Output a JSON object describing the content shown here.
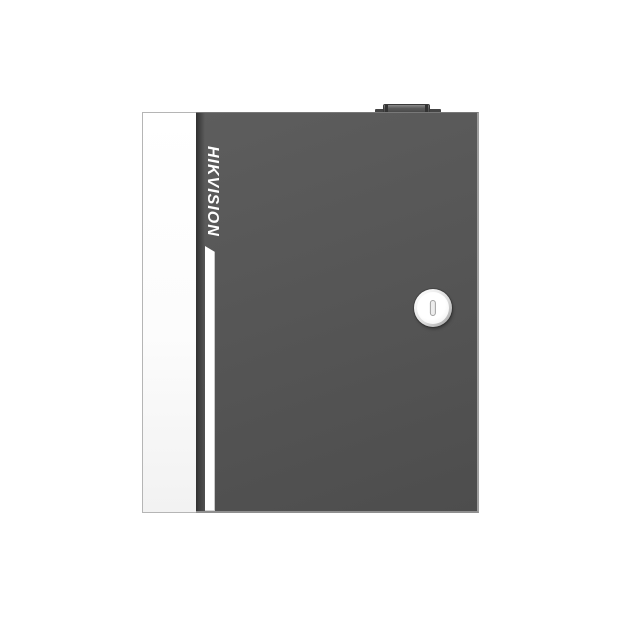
{
  "scene": {
    "type": "product-photo",
    "subject": "Wall-mount access control panel enclosure, front view, on white background"
  },
  "brand": {
    "logo_text": "HIKVISION"
  },
  "icons": {
    "keyhole_lock": "round-cam-lock-with-vertical-key-slot",
    "top_tab": "small-raised-latch-tab-on-top-edge"
  },
  "colors": {
    "background": "#ffffff",
    "door": "#565656",
    "door_top_highlight": "#787878",
    "door_edge_highlight": "#9e9e9e",
    "hinge_shadow": "#2f2f2f",
    "panel_white": "#fcfcfc",
    "panel_border": "#b5b5b5",
    "logo_white": "#ffffff",
    "stripe_white": "#ffffff",
    "stripe_edge": "#c9c9c9",
    "lock_ring_light": "#fafafa",
    "lock_ring_dark": "#9c9c9c",
    "lock_face": "#ffffff",
    "slot_fill": "#ededed",
    "slot_border": "#a0a0a0",
    "tab_light": "#8a8a8a",
    "tab_dark": "#454545"
  }
}
